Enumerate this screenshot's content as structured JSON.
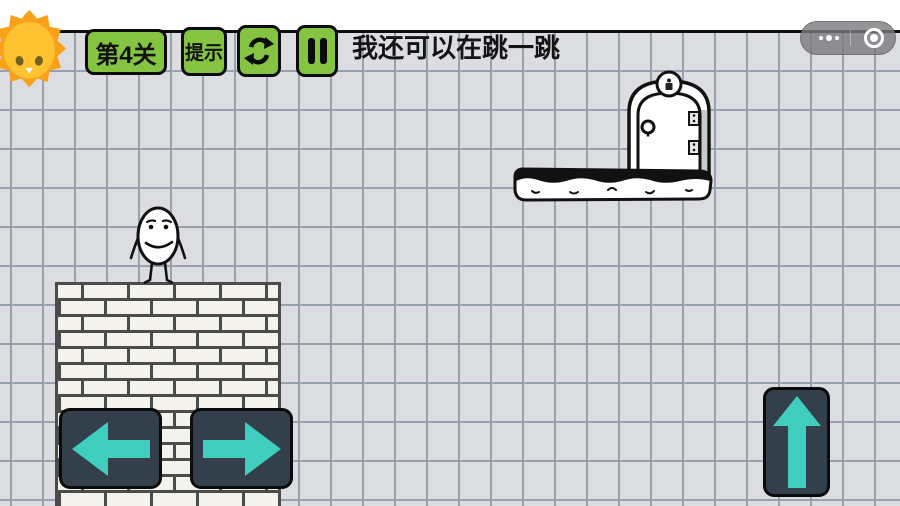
{
  "hud": {
    "level_label": "第4关",
    "hint_label": "提示",
    "speech_text": "我还可以在跳一跳"
  },
  "icons": {
    "logo": "sun-chick-face",
    "restart": "circular-refresh-arrows",
    "pause": "pause-bars",
    "capsule_more": "more-dots",
    "capsule_circle": "record-circle",
    "move_left": "arrow-left",
    "move_right": "arrow-right",
    "jump": "arrow-up"
  },
  "scene": {
    "character": "egg-man",
    "goal": "exit-door-on-ink-platform",
    "ground": "brick-wall"
  },
  "colors": {
    "paper": "#dcdde1",
    "grid_line": "#9aa1ae",
    "hud_green": "#84c440",
    "control_dark": "#333f4a",
    "control_teal": "#3fcdbe",
    "sun_orange": "#f9a11b",
    "sun_yellow": "#ffc331"
  }
}
